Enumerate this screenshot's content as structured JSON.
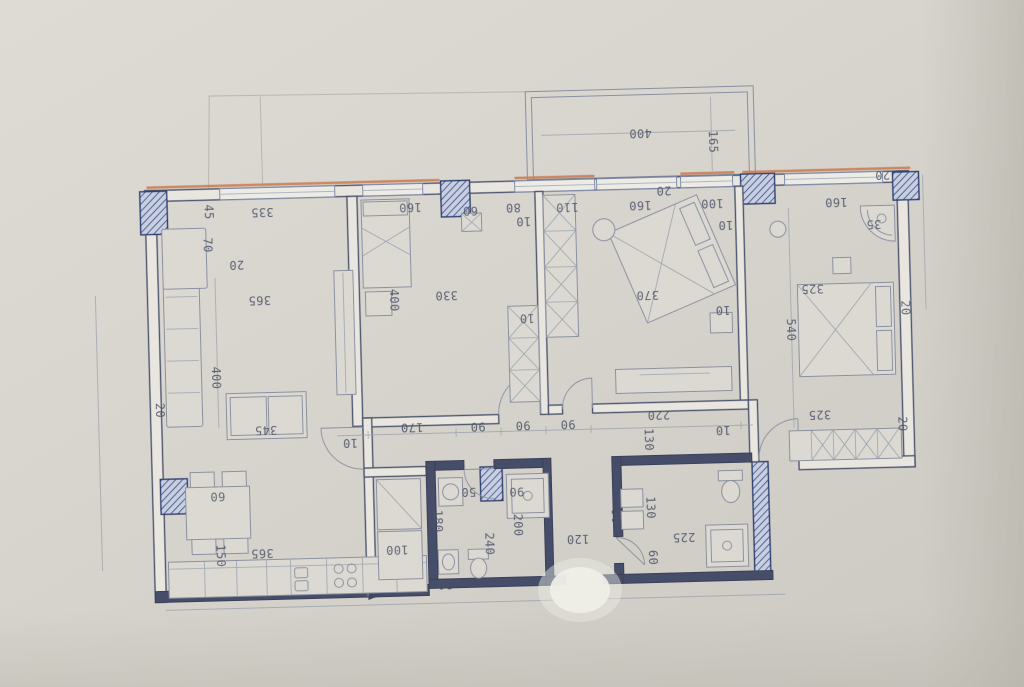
{
  "plan": {
    "type": "apartment-floor-plan-photo",
    "palette": {
      "paper": "#d8d5ce",
      "ink": "#4e566f",
      "wall_dark": "#454d68",
      "hatch_line": "#2f4070",
      "accent_orange": "#c97a4e",
      "furniture_line": "#8a90a0",
      "label_text": "#4d5468",
      "reflection": "#f1f0ea"
    },
    "dimension_labels": [
      {
        "t": "400",
        "x": 647,
        "y": 136,
        "r": 180
      },
      {
        "t": "165",
        "x": 719,
        "y": 147,
        "r": 90
      },
      {
        "t": "20",
        "x": 669,
        "y": 194,
        "r": 180
      },
      {
        "t": "45",
        "x": 213,
        "y": 204,
        "r": 90
      },
      {
        "t": "70",
        "x": 211,
        "y": 237,
        "r": 90
      },
      {
        "t": "335",
        "x": 267,
        "y": 205,
        "r": 180
      },
      {
        "t": "20",
        "x": 240,
        "y": 257,
        "r": 180
      },
      {
        "t": "365",
        "x": 262,
        "y": 293,
        "r": 180
      },
      {
        "t": "400",
        "x": 216,
        "y": 370,
        "r": 90
      },
      {
        "t": "20",
        "x": 159,
        "y": 401,
        "r": 90
      },
      {
        "t": "345",
        "x": 265,
        "y": 423,
        "r": 180
      },
      {
        "t": "160",
        "x": 415,
        "y": 204,
        "r": 180
      },
      {
        "t": "60",
        "x": 475,
        "y": 209,
        "r": 180
      },
      {
        "t": "80",
        "x": 518,
        "y": 207,
        "r": 180
      },
      {
        "t": "10",
        "x": 528,
        "y": 221,
        "r": 180
      },
      {
        "t": "110",
        "x": 572,
        "y": 208,
        "r": 180
      },
      {
        "t": "400",
        "x": 396,
        "y": 297,
        "r": 90
      },
      {
        "t": "330",
        "x": 449,
        "y": 293,
        "r": 180
      },
      {
        "t": "10",
        "x": 529,
        "y": 318,
        "r": 180
      },
      {
        "t": "160",
        "x": 645,
        "y": 208,
        "r": 180
      },
      {
        "t": "100",
        "x": 717,
        "y": 208,
        "r": 180
      },
      {
        "t": "10",
        "x": 730,
        "y": 230,
        "r": 180
      },
      {
        "t": "370",
        "x": 650,
        "y": 298,
        "r": 180
      },
      {
        "t": "10",
        "x": 725,
        "y": 315,
        "r": 180
      },
      {
        "t": "20",
        "x": 888,
        "y": 184,
        "r": 180
      },
      {
        "t": "160",
        "x": 841,
        "y": 210,
        "r": 180
      },
      {
        "t": "35",
        "x": 878,
        "y": 233,
        "r": 180
      },
      {
        "t": "325",
        "x": 815,
        "y": 296,
        "r": 180
      },
      {
        "t": "20",
        "x": 907,
        "y": 318,
        "r": 90
      },
      {
        "t": "540",
        "x": 792,
        "y": 337,
        "r": 90
      },
      {
        "t": "325",
        "x": 819,
        "y": 422,
        "r": 180
      },
      {
        "t": "20",
        "x": 901,
        "y": 434,
        "r": 90
      },
      {
        "t": "10",
        "x": 349,
        "y": 438,
        "r": 180
      },
      {
        "t": "170",
        "x": 411,
        "y": 424,
        "r": 180
      },
      {
        "t": "90",
        "x": 477,
        "y": 425,
        "r": 180
      },
      {
        "t": "90",
        "x": 522,
        "y": 425,
        "r": 180
      },
      {
        "t": "90",
        "x": 567,
        "y": 425,
        "r": 180
      },
      {
        "t": "220",
        "x": 658,
        "y": 418,
        "r": 180
      },
      {
        "t": "130",
        "x": 647,
        "y": 443,
        "r": 90
      },
      {
        "t": "10",
        "x": 722,
        "y": 435,
        "r": 180
      },
      {
        "t": "60",
        "x": 215,
        "y": 488,
        "r": 180
      },
      {
        "t": "150",
        "x": 216,
        "y": 548,
        "r": 90
      },
      {
        "t": "365",
        "x": 258,
        "y": 546,
        "r": 180
      },
      {
        "t": "100",
        "x": 393,
        "y": 546,
        "r": 180
      },
      {
        "t": "30",
        "x": 440,
        "y": 582,
        "r": 180
      },
      {
        "t": "50",
        "x": 466,
        "y": 490,
        "r": 180
      },
      {
        "t": "90",
        "x": 514,
        "y": 491,
        "r": 180
      },
      {
        "t": "180",
        "x": 434,
        "y": 519,
        "r": 90
      },
      {
        "t": "240",
        "x": 485,
        "y": 543,
        "r": 90
      },
      {
        "t": "200",
        "x": 514,
        "y": 525,
        "r": 90
      },
      {
        "t": "120",
        "x": 574,
        "y": 540,
        "r": 180
      },
      {
        "t": "130",
        "x": 647,
        "y": 511,
        "r": 90
      },
      {
        "t": "90",
        "x": 612,
        "y": 519,
        "r": 90
      },
      {
        "t": "225",
        "x": 680,
        "y": 541,
        "r": 180
      },
      {
        "t": "60",
        "x": 648,
        "y": 561,
        "r": 90
      }
    ]
  }
}
